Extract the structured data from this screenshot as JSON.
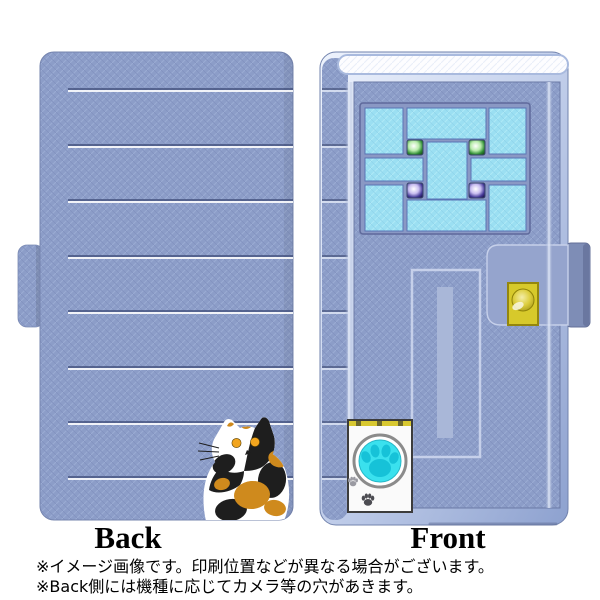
{
  "illustration": {
    "back": {
      "label": "Back"
    },
    "front": {
      "label": "Front"
    },
    "icons": [
      "calico-cat-illustration",
      "paw-print-icon",
      "keyhole-icon",
      "gem-green-icon",
      "gem-purple-icon"
    ],
    "colors": {
      "case_blue": "#8c9dc8",
      "stitch_white": "#ffffff",
      "window_pane_blue": "#9bdff2",
      "gem_green": "#2f8d34",
      "gem_purple": "#453a98",
      "lock_gold": "#d7c92b",
      "paw_cyan": "#3ae1ee",
      "cat_orange": "#cf8a1d",
      "cat_black": "#1e1e1e"
    }
  },
  "footnotes": {
    "line1": "※イメージ画像です。印刷位置などが異なる場合がございます。",
    "line2": "※Back側には機種に応じてカメラ等の穴があきます。"
  }
}
